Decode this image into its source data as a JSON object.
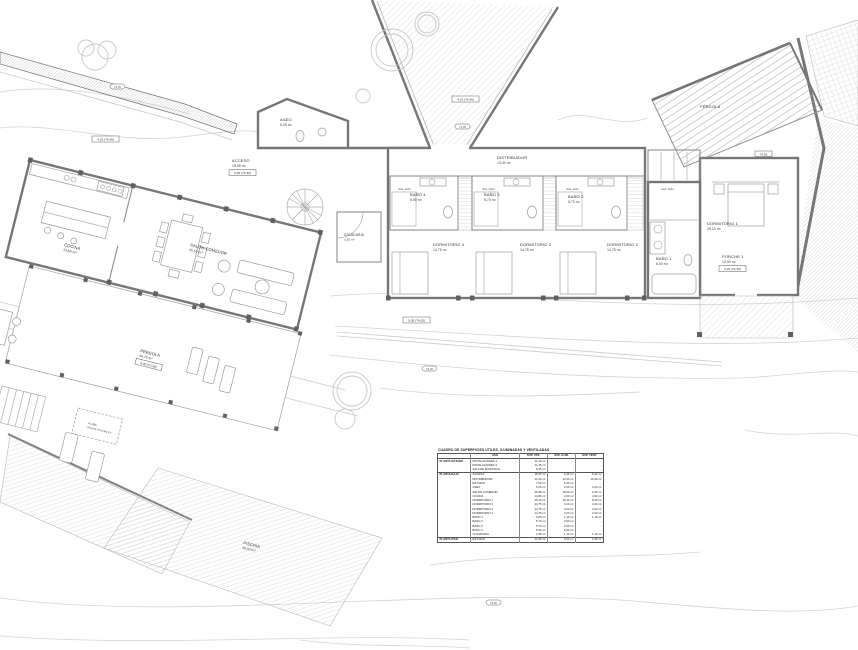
{
  "page": {
    "background": "#ffffff",
    "wall_color": "#767676",
    "contour_color": "#d3d3d3",
    "text_color": "#2e2e2e"
  },
  "rooms": {
    "cocina": {
      "name": "COCINA",
      "area": "13,80 m²"
    },
    "salon": {
      "name": "SALÓN-COMEDOR",
      "area": "45,50 m²"
    },
    "aseo": {
      "name": "ASEO",
      "area": "5,25 m²"
    },
    "acceso": {
      "name": "ACCESO",
      "area": "18,05 m²"
    },
    "distribuidor": {
      "name": "DISTRIBUIDOR",
      "area": "13,40 m²"
    },
    "dormitorio4": {
      "name": "DORMITORIO 4",
      "area": "14,75 m²"
    },
    "dormitorio3": {
      "name": "DORMITORIO 3",
      "area": "14,75 m²"
    },
    "dormitorio2": {
      "name": "DORMITORIO 2",
      "area": "14,75 m²"
    },
    "dormitorio1": {
      "name": "DORMITORIO 1",
      "area": "25,10 m²"
    },
    "bano4": {
      "name": "BAÑO 4",
      "area": "5,50 m²"
    },
    "bano3": {
      "name": "BAÑO 3",
      "area": "5,70 m²"
    },
    "bano2": {
      "name": "BAÑO 2",
      "area": "5,70 m²"
    },
    "bano1": {
      "name": "BAÑO 1",
      "area": "6,00 m²"
    },
    "porche": {
      "name": "PORCHE 1",
      "area": "13,90 m²"
    },
    "pergola": {
      "name": "PÉRGOLA",
      "area": "44,70 m²"
    },
    "pergola_top": {
      "name": "PÉRGOLA"
    },
    "piscina": {
      "name": "PISCINA",
      "area": "25,00 m²"
    },
    "coladuria": {
      "name": "COLADURIA",
      "area": "3,35 m²"
    }
  },
  "annotations": {
    "vest_bano": "Vest. baño",
    "aljibe1": "ALJIBE",
    "aljibe2": "AGUAS PLUVIALES"
  },
  "levels": {
    "l1": "4,15 (74,40)",
    "l2": "4,15 (74,40)",
    "l3": "0,20 (74,30)",
    "l4": "0,20 (74,30)",
    "l5": "0,20 (74,30)",
    "l6": "5,05 (74,05)",
    "l7": "74,00",
    "m1": "74,35",
    "m2": "74,30",
    "m3": "74,20",
    "m4": "73,50"
  },
  "surface_table": {
    "title": "CUADRO DE SUPERFICIES ÚTILES, ILUMINADAS Y VENTILADAS",
    "columns": [
      "USO",
      "SUP. ÚTIL",
      "SUP. ILUM.",
      "SUP. VENT."
    ],
    "sections": [
      {
        "name": "PLANTA SÓTANO",
        "rows": [
          [
            "INSTALACIONES 1",
            "11,30 m²",
            "-",
            "-"
          ],
          [
            "INSTALACIONES 2",
            "11,45 m²",
            "-",
            "-"
          ],
          [
            "SALA DE MÁQUINAS",
            "8,15 m²",
            "-",
            "-"
          ]
        ]
      },
      {
        "name": "PLANTA BAJA",
        "rows": [
          [
            "ACCESO",
            "18,05 m²",
            "5,40 m²",
            "5,40 m²"
          ],
          [
            "DISTRIBUIDOR",
            "13,40 m²",
            "10,40 m²",
            "10,40 m²"
          ],
          [
            "ESTUDIO",
            "7,50 m²",
            "5,40 m²",
            "-"
          ],
          [
            "ASEO",
            "5,25 m²",
            "3,20 m²",
            "3,20 m²"
          ],
          [
            "SALÓN-COMEDOR",
            "45,50 m²",
            "18,60 m²",
            "9,20 m²"
          ],
          [
            "COCINA",
            "13,80 m²",
            "4,60 m²",
            "4,60 m²"
          ],
          [
            "DORMITORIO 1",
            "25,10 m²",
            "10,40 m²",
            "8,40 m²"
          ],
          [
            "DORMITORIO 2",
            "14,75 m²",
            "3,20 m²",
            "3,20 m²"
          ],
          [
            "DORMITORIO 3",
            "14,75 m²",
            "3,20 m²",
            "3,20 m²"
          ],
          [
            "DORMITORIO 4",
            "14,75 m²",
            "3,20 m²",
            "3,20 m²"
          ],
          [
            "BAÑO 1",
            "6,00 m²",
            "1,10 m²",
            "1,10 m²"
          ],
          [
            "BAÑO 2",
            "5,70 m²",
            "0,60 m²",
            "-"
          ],
          [
            "BAÑO 3",
            "5,70 m²",
            "0,60 m²",
            "-"
          ],
          [
            "BAÑO 4",
            "5,50 m²",
            "0,60 m²",
            "-"
          ],
          [
            "COLADURIA",
            "3,35 m²",
            "1,10 m²",
            "1,10 m²"
          ]
        ]
      },
      {
        "name": "PLANTA PISO",
        "rows": [
          [
            "ESTUDIO",
            "14,40 m²",
            "5,60 m²",
            "2,40 m²"
          ]
        ]
      }
    ]
  }
}
